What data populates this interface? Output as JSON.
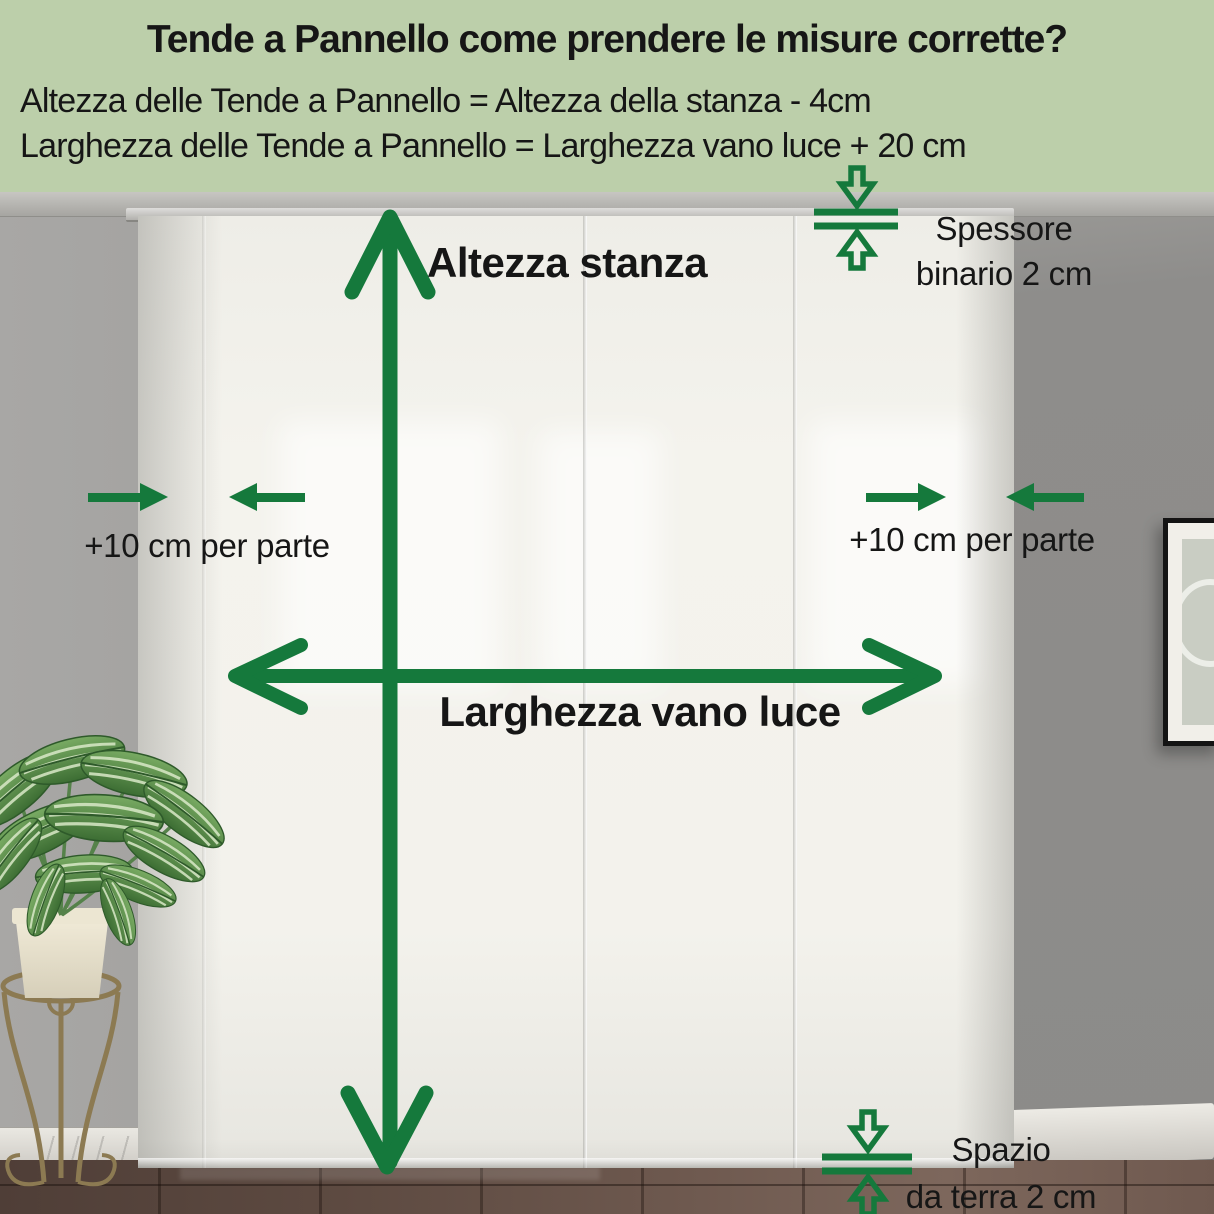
{
  "header": {
    "title": "Tende a Pannello come prendere le misure corrette?",
    "formula_height": "Altezza delle Tende a Pannello = Altezza della stanza - 4cm",
    "formula_width": "Larghezza delle Tende a Pannello = Larghezza vano luce + 20 cm"
  },
  "annotations": {
    "room_height": "Altezza stanza",
    "opening_width": "Larghezza vano luce",
    "side_margin": "+10 cm per parte",
    "rail_line1": "Spessore",
    "rail_line2": "binario 2 cm",
    "floor_gap_line1": "Spazio",
    "floor_gap_line2": "da terra 2 cm"
  },
  "colors": {
    "accent_green": "#15793c",
    "header_background": "#bccfaa",
    "text": "#161616"
  }
}
